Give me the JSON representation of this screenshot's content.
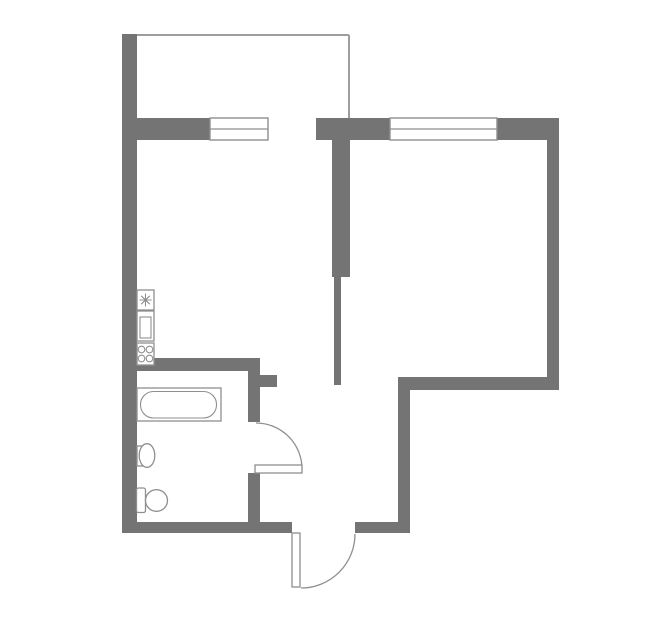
{
  "canvas": {
    "width": 659,
    "height": 635
  },
  "palette": {
    "bg": "#ffffff",
    "wall": "#747474",
    "thin": "#9d9d9d",
    "line": "#8f8f8f"
  },
  "floorplan": {
    "description": "one-room apartment floor plan",
    "shapes": [
      {
        "type": "line",
        "name": "balcony-outline-top",
        "cls": "thin",
        "x1": 126,
        "y1": 35,
        "x2": 349,
        "y2": 35
      },
      {
        "type": "line",
        "name": "balcony-outline-right",
        "cls": "thin",
        "x1": 349,
        "y1": 35,
        "x2": 349,
        "y2": 119
      },
      {
        "type": "rect",
        "name": "left-wall",
        "cls": "wall",
        "x": 122,
        "y": 34,
        "w": 15,
        "h": 499
      },
      {
        "type": "rect",
        "name": "top-wall-left",
        "cls": "wall",
        "x": 122,
        "y": 118,
        "w": 88,
        "h": 22
      },
      {
        "type": "rect",
        "name": "top-wall-mid",
        "cls": "wall",
        "x": 316,
        "y": 118,
        "w": 74,
        "h": 22
      },
      {
        "type": "rect",
        "name": "top-wall-right",
        "cls": "wall",
        "x": 497,
        "y": 118,
        "w": 62,
        "h": 22
      },
      {
        "type": "rect",
        "name": "right-wall",
        "cls": "wall",
        "x": 547,
        "y": 118,
        "w": 12,
        "h": 272
      },
      {
        "type": "rect",
        "name": "room-bottom-wall",
        "cls": "wall",
        "x": 398,
        "y": 377,
        "w": 161,
        "h": 13
      },
      {
        "type": "rect",
        "name": "hall-right-wall",
        "cls": "wall",
        "x": 398,
        "y": 377,
        "w": 12,
        "h": 156
      },
      {
        "type": "rect",
        "name": "bottom-wall-left",
        "cls": "wall",
        "x": 122,
        "y": 522,
        "w": 170,
        "h": 11
      },
      {
        "type": "rect",
        "name": "bottom-wall-right",
        "cls": "wall",
        "x": 355,
        "y": 522,
        "w": 55,
        "h": 11
      },
      {
        "type": "rect",
        "name": "interior-wall-thick",
        "cls": "wall",
        "x": 332,
        "y": 140,
        "w": 18,
        "h": 137
      },
      {
        "type": "rect",
        "name": "interior-wall-thin",
        "cls": "wall",
        "x": 334,
        "y": 277,
        "w": 7,
        "h": 108
      },
      {
        "type": "rect",
        "name": "bathroom-top-wall",
        "cls": "wall",
        "x": 122,
        "y": 358,
        "w": 138,
        "h": 13
      },
      {
        "type": "rect",
        "name": "bathroom-right-wall-upper",
        "cls": "wall",
        "x": 248,
        "y": 358,
        "w": 12,
        "h": 64
      },
      {
        "type": "rect",
        "name": "bathroom-stub-wall",
        "cls": "wall",
        "x": 260,
        "y": 375,
        "w": 17,
        "h": 12
      },
      {
        "type": "rect",
        "name": "bathroom-right-wall-lower",
        "cls": "wall",
        "x": 248,
        "y": 473,
        "w": 12,
        "h": 60
      },
      {
        "type": "rect",
        "name": "balcony-window",
        "cls": "window",
        "x": 210,
        "y": 118,
        "w": 58,
        "h": 22
      },
      {
        "type": "line",
        "name": "balcony-window-mullion",
        "cls": "winline",
        "x1": 210,
        "y1": 129,
        "x2": 268,
        "y2": 129
      },
      {
        "type": "rect",
        "name": "room-window",
        "cls": "window",
        "x": 390,
        "y": 118,
        "w": 107,
        "h": 22
      },
      {
        "type": "line",
        "name": "room-window-mullion",
        "cls": "winline",
        "x1": 390,
        "y1": 129,
        "x2": 497,
        "y2": 129
      },
      {
        "type": "path",
        "name": "bathroom-door-arc",
        "cls": "arc",
        "d": "M 256 423 A 46 46 0 0 1 302 469"
      },
      {
        "type": "path",
        "name": "entry-door-arc",
        "cls": "arc",
        "d": "M 355 534 A 54 54 0 0 1 301 588"
      },
      {
        "type": "rect",
        "name": "bathroom-door-leaf",
        "cls": "leaf",
        "x": 255,
        "y": 465,
        "w": 47,
        "h": 8
      },
      {
        "type": "rect",
        "name": "entry-door-leaf",
        "cls": "leaf",
        "x": 292,
        "y": 533,
        "w": 8,
        "h": 54
      },
      {
        "type": "rect",
        "name": "kitchen-heater-box",
        "cls": "fixture",
        "x": 137,
        "y": 290,
        "w": 17,
        "h": 20
      },
      {
        "type": "path",
        "name": "kitchen-heater-star-icon",
        "cls": "fixline",
        "d": "M 145.5 293.5 L 145.5 306.5 M 139.5 300 L 151.5 300 M 141.2 295.8 L 149.8 304.2 M 149.8 295.8 L 141.2 304.2"
      },
      {
        "type": "rect",
        "name": "kitchen-sink-box",
        "cls": "fixture",
        "x": 137,
        "y": 311,
        "w": 17,
        "h": 30
      },
      {
        "type": "rect",
        "name": "kitchen-sink-basin",
        "cls": "fixline",
        "x": 140,
        "y": 317,
        "w": 11,
        "h": 21
      },
      {
        "type": "rect",
        "name": "stove-box",
        "cls": "fixture",
        "x": 137,
        "y": 343,
        "w": 17,
        "h": 22
      },
      {
        "type": "circle",
        "name": "stove-burner-1",
        "cls": "fixline",
        "cx": 141.5,
        "cy": 349.5,
        "r": 3.3
      },
      {
        "type": "circle",
        "name": "stove-burner-2",
        "cls": "fixline",
        "cx": 149.5,
        "cy": 349.5,
        "r": 3.3
      },
      {
        "type": "circle",
        "name": "stove-burner-3",
        "cls": "fixline",
        "cx": 141.5,
        "cy": 358.5,
        "r": 3.3
      },
      {
        "type": "circle",
        "name": "stove-burner-4",
        "cls": "fixline",
        "cx": 149.5,
        "cy": 358.5,
        "r": 3.3
      },
      {
        "type": "rect",
        "name": "bathtub-outer",
        "cls": "fixture",
        "x": 137,
        "y": 388,
        "w": 84,
        "h": 33
      },
      {
        "type": "rect",
        "name": "bathtub-inner",
        "cls": "fixline",
        "x": 140.5,
        "y": 391.5,
        "w": 76,
        "h": 26.5,
        "rx": 13
      },
      {
        "type": "rect",
        "name": "bath-sink-backplate",
        "cls": "fixture",
        "x": 137,
        "y": 446,
        "w": 5.5,
        "h": 20
      },
      {
        "type": "ellipse",
        "name": "bath-sink-bowl",
        "cls": "fixture",
        "cx": 147,
        "cy": 455.5,
        "rx": 7.8,
        "ry": 11.8
      },
      {
        "type": "rect",
        "name": "toilet-tank",
        "cls": "fixture",
        "x": 136.5,
        "y": 488,
        "w": 9,
        "h": 24.5,
        "rx": 2
      },
      {
        "type": "ellipse",
        "name": "toilet-bowl",
        "cls": "fixture",
        "cx": 156.5,
        "cy": 500.5,
        "rx": 11,
        "ry": 10.8
      }
    ]
  }
}
